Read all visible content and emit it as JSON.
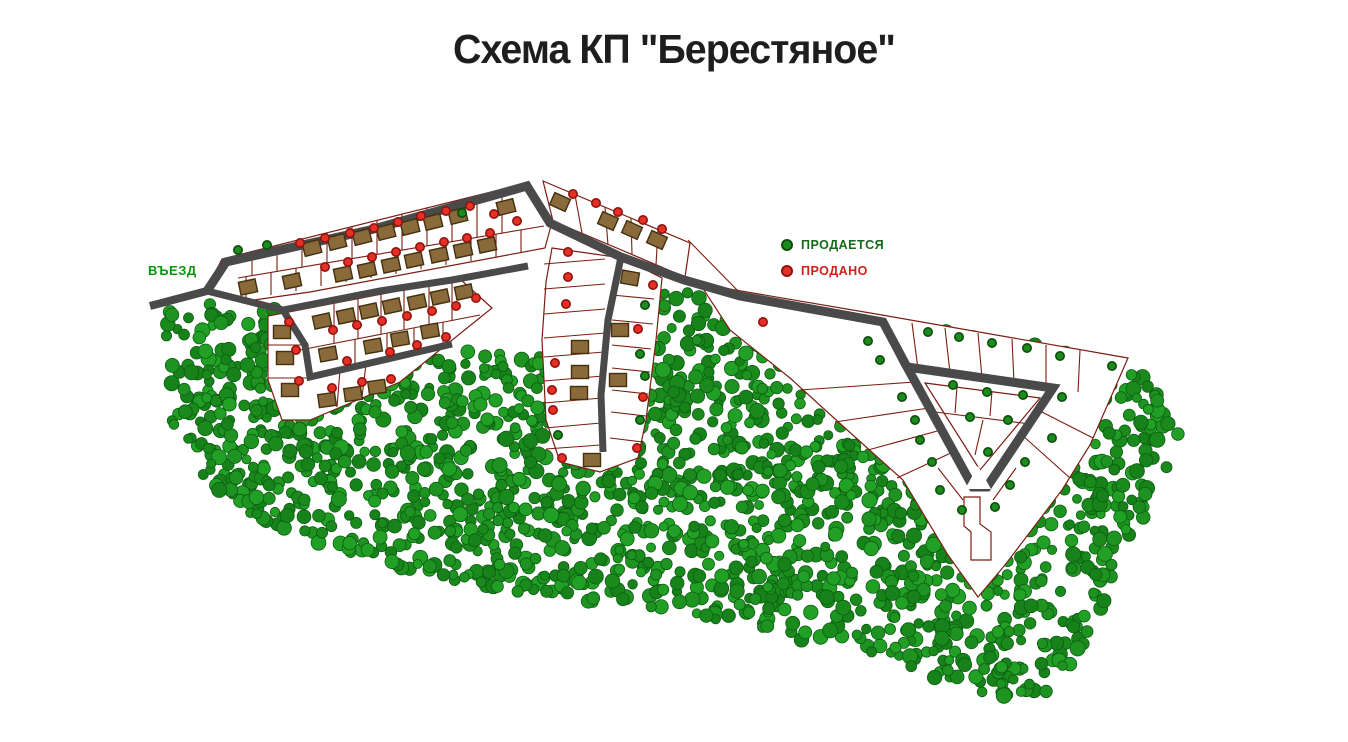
{
  "title": "Схема КП \"Берестяное\"",
  "legend": {
    "for_sale": {
      "label": "ПРОДАЕТСЯ",
      "color": "#1c8a1c"
    },
    "sold": {
      "label": "ПРОДАНО",
      "color": "#e63026"
    }
  },
  "entrance_label": "ВЪЕЗД",
  "map": {
    "width": 1348,
    "height": 742,
    "style": {
      "road_color": "#4a4a4a",
      "plot_line_color": "#7b1d12",
      "plot_fill": "#ffffff",
      "house_fill": "#8a6a3a",
      "house_stroke": "#43300e",
      "marker_sold_fill": "#e63026",
      "marker_sold_stroke": "#8f1410",
      "marker_sale_fill": "#1c8a1c",
      "marker_sale_stroke": "#0c4f0c",
      "tree_palette": [
        "#1e9321",
        "#1a8a1d",
        "#22a026",
        "#17821a"
      ],
      "tree_stroke": "#0b5e11"
    },
    "forest": {
      "seed": 11,
      "count": 2100,
      "polygon": [
        [
          165,
          305
        ],
        [
          255,
          300
        ],
        [
          330,
          326
        ],
        [
          420,
          344
        ],
        [
          505,
          352
        ],
        [
          540,
          356
        ],
        [
          640,
          295
        ],
        [
          700,
          292
        ],
        [
          883,
          323
        ],
        [
          1128,
          358
        ],
        [
          1185,
          430
        ],
        [
          1140,
          525
        ],
        [
          1105,
          600
        ],
        [
          1080,
          655
        ],
        [
          1045,
          693
        ],
        [
          1000,
          700
        ],
        [
          955,
          688
        ],
        [
          905,
          665
        ],
        [
          855,
          652
        ],
        [
          800,
          640
        ],
        [
          745,
          625
        ],
        [
          680,
          612
        ],
        [
          600,
          603
        ],
        [
          520,
          592
        ],
        [
          420,
          575
        ],
        [
          330,
          550
        ],
        [
          260,
          520
        ],
        [
          200,
          480
        ],
        [
          170,
          420
        ]
      ]
    },
    "blocks": [
      {
        "name": "block-northwest",
        "points": "206,290 222,259 527,183 552,222 545,248 310,292 240,302"
      },
      {
        "name": "block-top-middle",
        "points": "543,181 690,243 685,277 553,221"
      },
      {
        "name": "block-west-2",
        "points": "268,316 460,279 492,308 400,382 310,420 282,420 268,380"
      },
      {
        "name": "block-middle-col",
        "points": "552,248 622,258 662,278 656,340 646,420 638,458 600,472 560,462 546,420 542,340 546,282"
      },
      {
        "name": "block-east",
        "points": "700,284 882,315 1128,358 1090,445 1062,490 1005,565 978,597 948,555 903,480 845,428 790,378 730,330"
      },
      {
        "name": "inner-triangle",
        "points": "925,383 1040,398 980,470"
      }
    ],
    "plot_lines": [
      [
        238,
        278,
        544,
        226
      ],
      [
        252,
        252,
        252,
        276
      ],
      [
        277,
        245,
        277,
        271
      ],
      [
        302,
        239,
        302,
        267
      ],
      [
        327,
        233,
        327,
        263
      ],
      [
        352,
        227,
        352,
        259
      ],
      [
        377,
        220,
        377,
        254
      ],
      [
        402,
        214,
        402,
        250
      ],
      [
        427,
        208,
        427,
        246
      ],
      [
        452,
        202,
        452,
        242
      ],
      [
        477,
        196,
        477,
        237
      ],
      [
        502,
        189,
        502,
        233
      ],
      [
        246,
        277,
        246,
        299
      ],
      [
        271,
        272,
        271,
        295
      ],
      [
        296,
        268,
        296,
        291
      ],
      [
        321,
        264,
        321,
        286
      ],
      [
        346,
        260,
        346,
        282
      ],
      [
        371,
        255,
        371,
        278
      ],
      [
        396,
        251,
        396,
        274
      ],
      [
        421,
        247,
        421,
        269
      ],
      [
        446,
        243,
        446,
        265
      ],
      [
        471,
        239,
        471,
        261
      ],
      [
        496,
        234,
        496,
        257
      ],
      [
        521,
        230,
        521,
        252
      ],
      [
        575,
        195,
        582,
        233
      ],
      [
        605,
        207,
        608,
        245
      ],
      [
        631,
        218,
        632,
        254
      ],
      [
        658,
        229,
        656,
        265
      ],
      [
        300,
        350,
        480,
        315
      ],
      [
        334,
        303,
        334,
        343
      ],
      [
        358,
        299,
        358,
        339
      ],
      [
        381,
        294,
        381,
        334
      ],
      [
        404,
        290,
        404,
        330
      ],
      [
        429,
        285,
        429,
        325
      ],
      [
        452,
        281,
        452,
        321
      ],
      [
        355,
        339,
        355,
        367
      ],
      [
        387,
        333,
        387,
        359
      ],
      [
        414,
        328,
        414,
        353
      ],
      [
        443,
        322,
        443,
        346
      ],
      [
        340,
        370,
        337,
        407
      ],
      [
        366,
        364,
        362,
        397
      ],
      [
        268,
        345,
        306,
        345
      ],
      [
        268,
        378,
        308,
        378
      ],
      [
        544,
        264,
        605,
        259
      ],
      [
        544,
        289,
        605,
        284
      ],
      [
        544,
        314,
        605,
        309
      ],
      [
        544,
        338,
        605,
        333
      ],
      [
        544,
        357,
        604,
        352
      ],
      [
        544,
        381,
        603,
        376
      ],
      [
        544,
        403,
        602,
        398
      ],
      [
        545,
        428,
        601,
        423
      ],
      [
        546,
        449,
        600,
        445
      ],
      [
        612,
        295,
        654,
        299
      ],
      [
        612,
        320,
        653,
        324
      ],
      [
        612,
        345,
        651,
        349
      ],
      [
        612,
        368,
        650,
        372
      ],
      [
        612,
        390,
        648,
        394
      ],
      [
        611,
        412,
        646,
        416
      ],
      [
        610,
        438,
        643,
        442
      ],
      [
        912,
        323,
        918,
        369
      ],
      [
        945,
        328,
        950,
        373
      ],
      [
        978,
        333,
        982,
        378
      ],
      [
        1012,
        339,
        1014,
        382
      ],
      [
        1046,
        345,
        1046,
        387
      ],
      [
        1080,
        350,
        1078,
        392
      ],
      [
        800,
        390,
        915,
        382
      ],
      [
        835,
        422,
        929,
        408
      ],
      [
        868,
        450,
        941,
        430
      ],
      [
        897,
        478,
        953,
        452
      ],
      [
        957,
        387,
        955,
        413
      ],
      [
        992,
        391,
        990,
        416
      ],
      [
        935,
        412,
        1030,
        424
      ],
      [
        983,
        420,
        975,
        455
      ],
      [
        1038,
        410,
        1093,
        438
      ],
      [
        1022,
        435,
        1070,
        478
      ],
      [
        938,
        468,
        963,
        500
      ],
      [
        1016,
        468,
        993,
        500
      ],
      [
        688,
        240,
        740,
        293
      ]
    ],
    "roads": [
      {
        "name": "entrance-road",
        "width": 8,
        "closed": false,
        "points": [
          [
            150,
            306
          ],
          [
            207,
            291
          ]
        ]
      },
      {
        "name": "main-road",
        "width": 9,
        "closed": false,
        "points": [
          [
            207,
            291
          ],
          [
            226,
            262
          ],
          [
            370,
            230
          ],
          [
            527,
            186
          ],
          [
            550,
            223
          ],
          [
            621,
            257
          ],
          [
            684,
            280
          ],
          [
            740,
            296
          ],
          [
            883,
            322
          ],
          [
            907,
            367
          ]
        ]
      },
      {
        "name": "triangle-loop-road",
        "width": 9,
        "closed": true,
        "points": [
          [
            907,
            367
          ],
          [
            1053,
            388
          ],
          [
            987,
            487
          ],
          [
            973,
            487
          ]
        ]
      },
      {
        "name": "west-lower-road",
        "width": 7,
        "closed": false,
        "points": [
          [
            207,
            291
          ],
          [
            283,
            310
          ],
          [
            305,
            345
          ],
          [
            310,
            377
          ],
          [
            452,
            344
          ]
        ]
      },
      {
        "name": "west-upper-road",
        "width": 7,
        "closed": false,
        "points": [
          [
            283,
            310
          ],
          [
            380,
            291
          ],
          [
            452,
            280
          ],
          [
            528,
            266
          ]
        ]
      },
      {
        "name": "middle-road",
        "width": 7,
        "closed": false,
        "points": [
          [
            621,
            257
          ],
          [
            608,
            320
          ],
          [
            601,
            395
          ],
          [
            603,
            452
          ]
        ]
      }
    ],
    "notch": "965,489 991,489 978,466",
    "corridor": "964,497 980,497 980,524 991,532 991,560 971,560 971,532 964,526",
    "houses": [
      [
        312,
        248,
        -14
      ],
      [
        337,
        242,
        -14
      ],
      [
        362,
        237,
        -14
      ],
      [
        386,
        232,
        -14
      ],
      [
        410,
        227,
        -14
      ],
      [
        433,
        222,
        -14
      ],
      [
        458,
        216,
        -14
      ],
      [
        506,
        207,
        -14
      ],
      [
        248,
        287,
        -12
      ],
      [
        292,
        281,
        -12
      ],
      [
        343,
        274,
        -12
      ],
      [
        367,
        270,
        -12
      ],
      [
        391,
        265,
        -12
      ],
      [
        414,
        260,
        -12
      ],
      [
        439,
        255,
        -12
      ],
      [
        463,
        250,
        -12
      ],
      [
        487,
        245,
        -12
      ],
      [
        560,
        202,
        24
      ],
      [
        608,
        221,
        24
      ],
      [
        632,
        230,
        24
      ],
      [
        657,
        240,
        24
      ],
      [
        322,
        321,
        -12
      ],
      [
        346,
        316,
        -12
      ],
      [
        369,
        311,
        -12
      ],
      [
        392,
        306,
        -12
      ],
      [
        417,
        302,
        -12
      ],
      [
        440,
        297,
        -12
      ],
      [
        464,
        292,
        -12
      ],
      [
        328,
        354,
        -10
      ],
      [
        373,
        346,
        -10
      ],
      [
        400,
        339,
        -10
      ],
      [
        430,
        331,
        -10
      ],
      [
        327,
        400,
        -8
      ],
      [
        353,
        394,
        -8
      ],
      [
        377,
        387,
        -8
      ],
      [
        282,
        332,
        0
      ],
      [
        285,
        358,
        0
      ],
      [
        290,
        390,
        0
      ],
      [
        580,
        347,
        0
      ],
      [
        580,
        372,
        0
      ],
      [
        579,
        393,
        0
      ],
      [
        592,
        460,
        0
      ],
      [
        630,
        278,
        10
      ],
      [
        620,
        330,
        0
      ],
      [
        618,
        380,
        0
      ]
    ],
    "markers": [
      [
        300,
        243,
        "s"
      ],
      [
        325,
        238,
        "s"
      ],
      [
        350,
        233,
        "s"
      ],
      [
        374,
        228,
        "s"
      ],
      [
        398,
        222,
        "s"
      ],
      [
        421,
        216,
        "s"
      ],
      [
        446,
        211,
        "s"
      ],
      [
        470,
        206,
        "s"
      ],
      [
        494,
        214,
        "s"
      ],
      [
        517,
        221,
        "s"
      ],
      [
        325,
        267,
        "s"
      ],
      [
        348,
        262,
        "s"
      ],
      [
        372,
        257,
        "s"
      ],
      [
        396,
        252,
        "s"
      ],
      [
        420,
        247,
        "s"
      ],
      [
        444,
        242,
        "s"
      ],
      [
        467,
        238,
        "s"
      ],
      [
        490,
        233,
        "s"
      ],
      [
        238,
        250,
        "f"
      ],
      [
        267,
        245,
        "f"
      ],
      [
        462,
        213,
        "f"
      ],
      [
        573,
        194,
        "s"
      ],
      [
        596,
        203,
        "s"
      ],
      [
        618,
        212,
        "s"
      ],
      [
        643,
        220,
        "s"
      ],
      [
        662,
        229,
        "s"
      ],
      [
        333,
        330,
        "s"
      ],
      [
        357,
        325,
        "s"
      ],
      [
        382,
        321,
        "s"
      ],
      [
        407,
        316,
        "s"
      ],
      [
        432,
        311,
        "s"
      ],
      [
        456,
        306,
        "s"
      ],
      [
        476,
        298,
        "s"
      ],
      [
        347,
        361,
        "s"
      ],
      [
        390,
        352,
        "s"
      ],
      [
        417,
        345,
        "s"
      ],
      [
        446,
        337,
        "s"
      ],
      [
        332,
        388,
        "s"
      ],
      [
        362,
        382,
        "s"
      ],
      [
        391,
        379,
        "s"
      ],
      [
        289,
        322,
        "s"
      ],
      [
        296,
        350,
        "s"
      ],
      [
        299,
        381,
        "s"
      ],
      [
        568,
        252,
        "s"
      ],
      [
        568,
        277,
        "s"
      ],
      [
        566,
        304,
        "s"
      ],
      [
        555,
        363,
        "s"
      ],
      [
        552,
        390,
        "s"
      ],
      [
        553,
        410,
        "s"
      ],
      [
        562,
        458,
        "s"
      ],
      [
        558,
        435,
        "f"
      ],
      [
        653,
        285,
        "s"
      ],
      [
        638,
        329,
        "s"
      ],
      [
        643,
        397,
        "s"
      ],
      [
        637,
        448,
        "s"
      ],
      [
        645,
        305,
        "f"
      ],
      [
        640,
        354,
        "f"
      ],
      [
        645,
        376,
        "f"
      ],
      [
        640,
        420,
        "f"
      ],
      [
        763,
        322,
        "s"
      ],
      [
        928,
        332,
        "f"
      ],
      [
        959,
        337,
        "f"
      ],
      [
        992,
        343,
        "f"
      ],
      [
        1027,
        348,
        "f"
      ],
      [
        1060,
        356,
        "f"
      ],
      [
        1112,
        366,
        "f"
      ],
      [
        868,
        341,
        "f"
      ],
      [
        880,
        360,
        "f"
      ],
      [
        902,
        397,
        "f"
      ],
      [
        915,
        420,
        "f"
      ],
      [
        920,
        440,
        "f"
      ],
      [
        932,
        462,
        "f"
      ],
      [
        953,
        385,
        "f"
      ],
      [
        987,
        392,
        "f"
      ],
      [
        1023,
        395,
        "f"
      ],
      [
        970,
        417,
        "f"
      ],
      [
        1008,
        420,
        "f"
      ],
      [
        988,
        452,
        "f"
      ],
      [
        1062,
        397,
        "f"
      ],
      [
        1052,
        438,
        "f"
      ],
      [
        940,
        490,
        "f"
      ],
      [
        1010,
        485,
        "f"
      ],
      [
        1025,
        462,
        "f"
      ],
      [
        962,
        510,
        "f"
      ],
      [
        995,
        507,
        "f"
      ]
    ]
  }
}
